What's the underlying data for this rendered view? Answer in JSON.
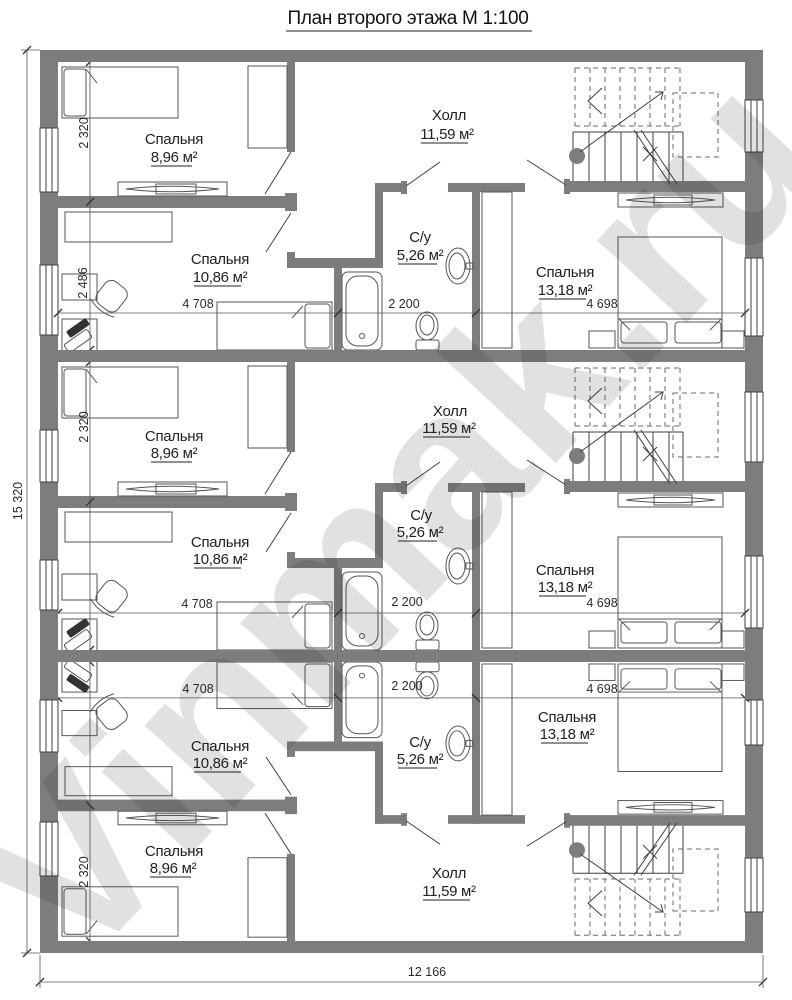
{
  "title": "План второго этажа М 1:100",
  "watermark": "Vinmak.ru",
  "rooms": {
    "bedroom_small": {
      "name": "Спальня",
      "area": "8,96 м²"
    },
    "bedroom_middle": {
      "name": "Спальня",
      "area": "10,86 м²"
    },
    "bedroom_large": {
      "name": "Спальня",
      "area": "13,18 м²"
    },
    "hall": {
      "name": "Холл",
      "area": "11,59 м²"
    },
    "wc": {
      "name": "С/у",
      "area": "5,26 м²"
    }
  },
  "dims": {
    "bedroom_small_width": "2 320",
    "bedroom_middle_width": "2 486",
    "bedroom_middle_length": "4 708",
    "wc_width": "2 200",
    "bedroom_large_length": "4 698",
    "total_width": "12 166",
    "total_height": "15 320"
  }
}
